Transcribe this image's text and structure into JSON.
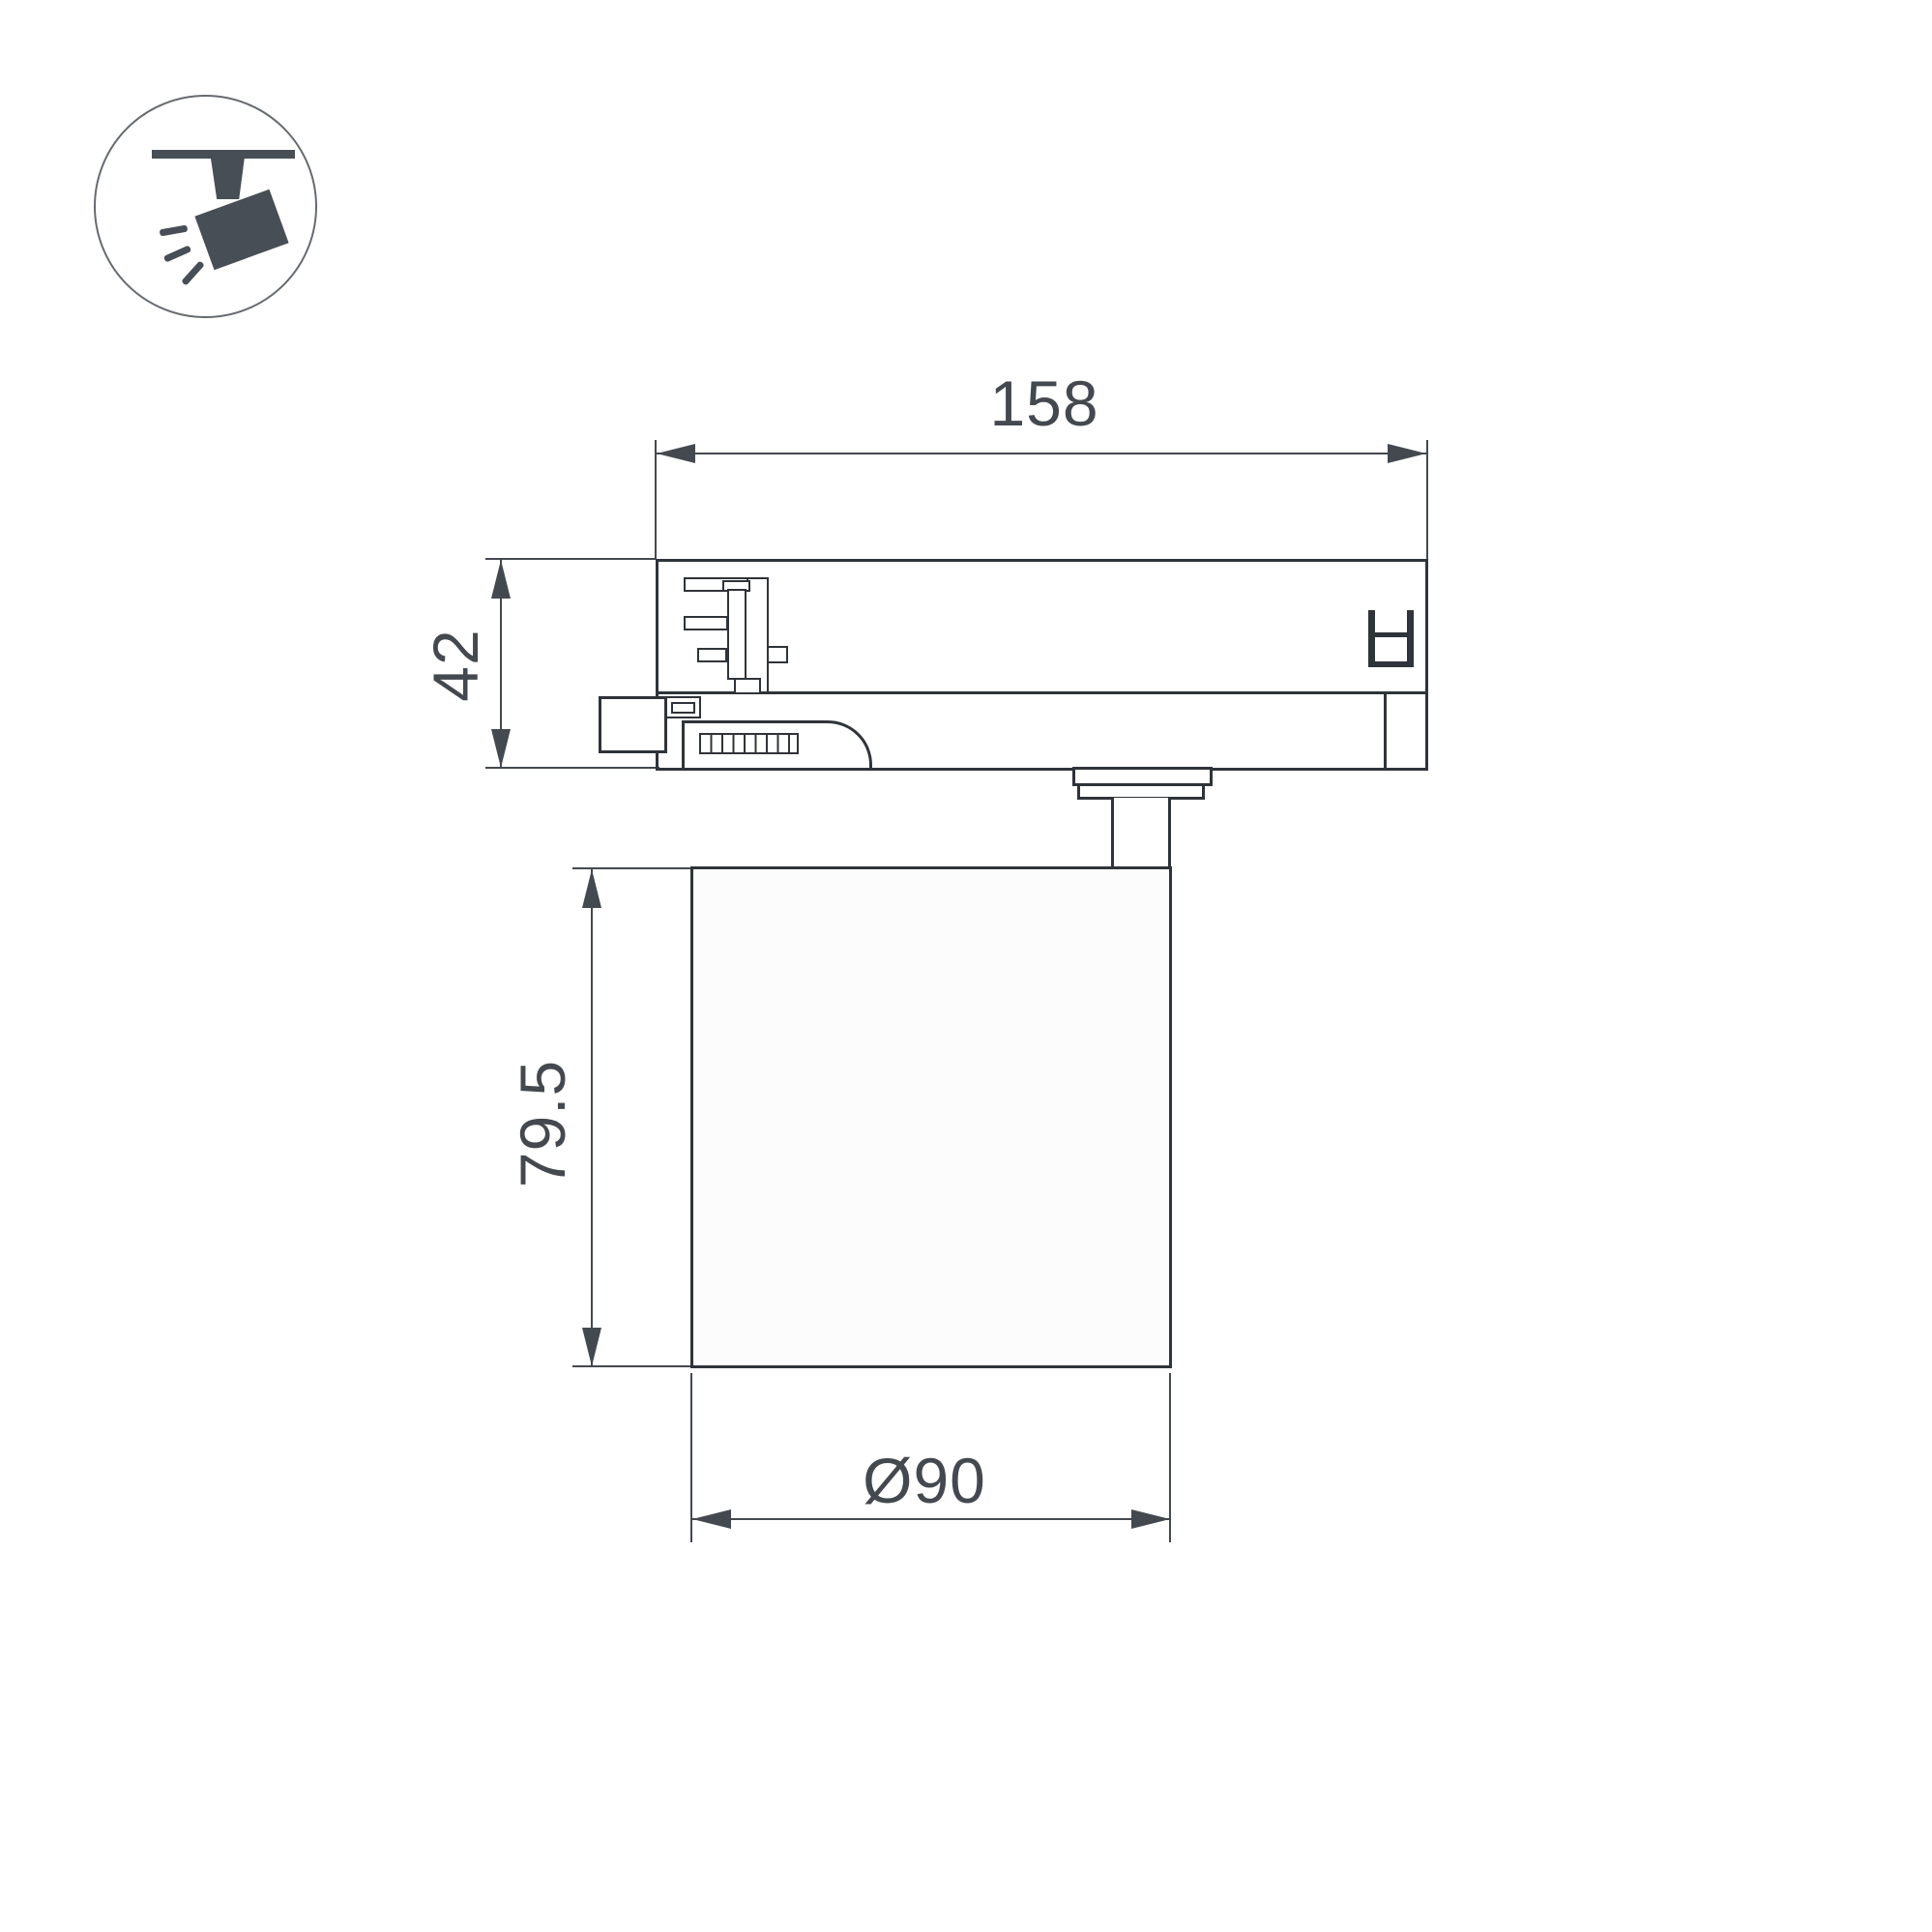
{
  "icon": {
    "name": "track-spotlight-icon"
  },
  "dimensions": {
    "track_length": {
      "label": "158"
    },
    "adapter_height": {
      "label": "42"
    },
    "body_height": {
      "label": "79.5"
    },
    "body_diameter": {
      "label": "Ø90"
    }
  },
  "colors": {
    "line": "#2f343a",
    "dim": "#43494f",
    "icon": "#474e55",
    "background": "#ffffff"
  }
}
